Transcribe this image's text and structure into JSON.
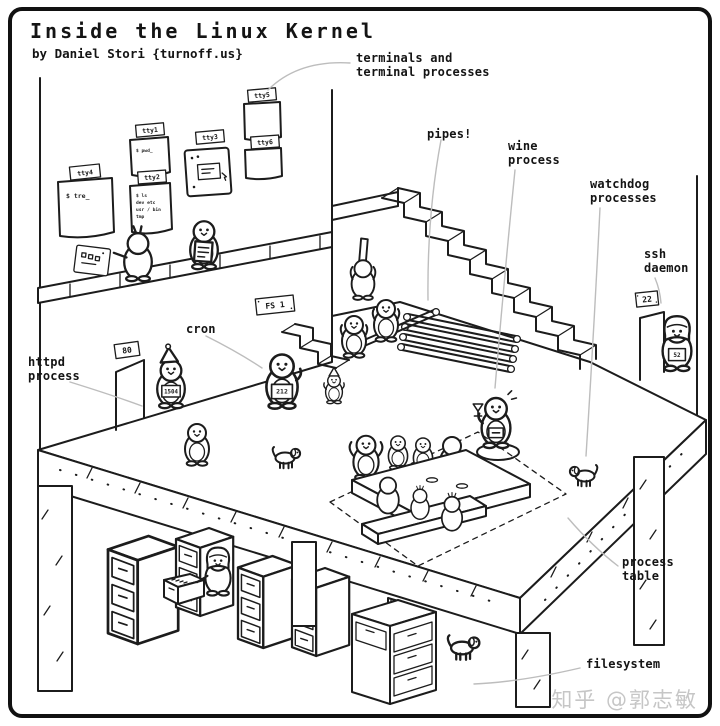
{
  "title": "Inside the Linux Kernel",
  "subtitle": "by Daniel Stori {turnoff.us}",
  "watermark": "知乎 @郭志敏",
  "colors": {
    "ink": "#1c1c1c",
    "leader": "#bdbdbd",
    "watermark": "#c6c6c6",
    "paper": "#ffffff"
  },
  "labels": {
    "terminals_line1": "terminals and",
    "terminals_line2": "terminal processes",
    "pipes": "pipes!",
    "wine_line1": "wine",
    "wine_line2": "process",
    "watchdog_line1": "watchdog",
    "watchdog_line2": "processes",
    "ssh_line1": "ssh",
    "ssh_line2": "daemon",
    "httpd_line1": "httpd",
    "httpd_line2": "process",
    "cron": "cron",
    "process_table_line1": "process",
    "process_table_line2": "table",
    "filesystem": "filesystem"
  },
  "signs": {
    "tty1": "tty1",
    "tty2": "tty2",
    "tty3": "tty3",
    "tty4": "tty4",
    "tty5": "tty5",
    "tty6": "tty6",
    "fs1": "FS 1",
    "port_http": "80",
    "port_ssh": "22"
  },
  "terminals": {
    "tty4_text": "$ tre_",
    "tty1_text": "$ pwd_",
    "tty2_lines": [
      "$ ls",
      "dev etc",
      "usr / bin",
      "tmp"
    ]
  },
  "badges": {
    "cron": "212",
    "httpd": "1504",
    "ssh": "52"
  }
}
